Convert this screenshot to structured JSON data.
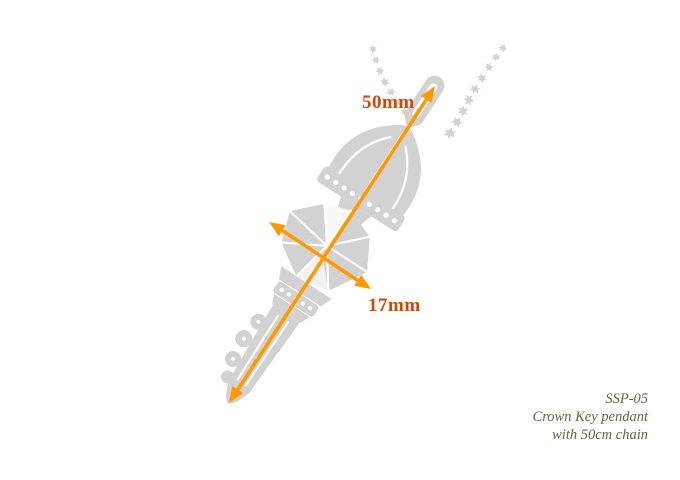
{
  "colors": {
    "background": "#ffffff",
    "pendant": "#d2d2d2",
    "detail": "#ffffff",
    "arrow": "#ff9900",
    "dimension_label": "#d14800",
    "caption": "#666649"
  },
  "dimensions": {
    "length_label": "50mm",
    "width_label": "17mm"
  },
  "caption": {
    "lines": [
      "SSP-05",
      "Crown Key pendant",
      "with 50cm chain"
    ]
  },
  "icons": {
    "pendant": "crown-key-silhouette",
    "chain": "bead-chain"
  }
}
